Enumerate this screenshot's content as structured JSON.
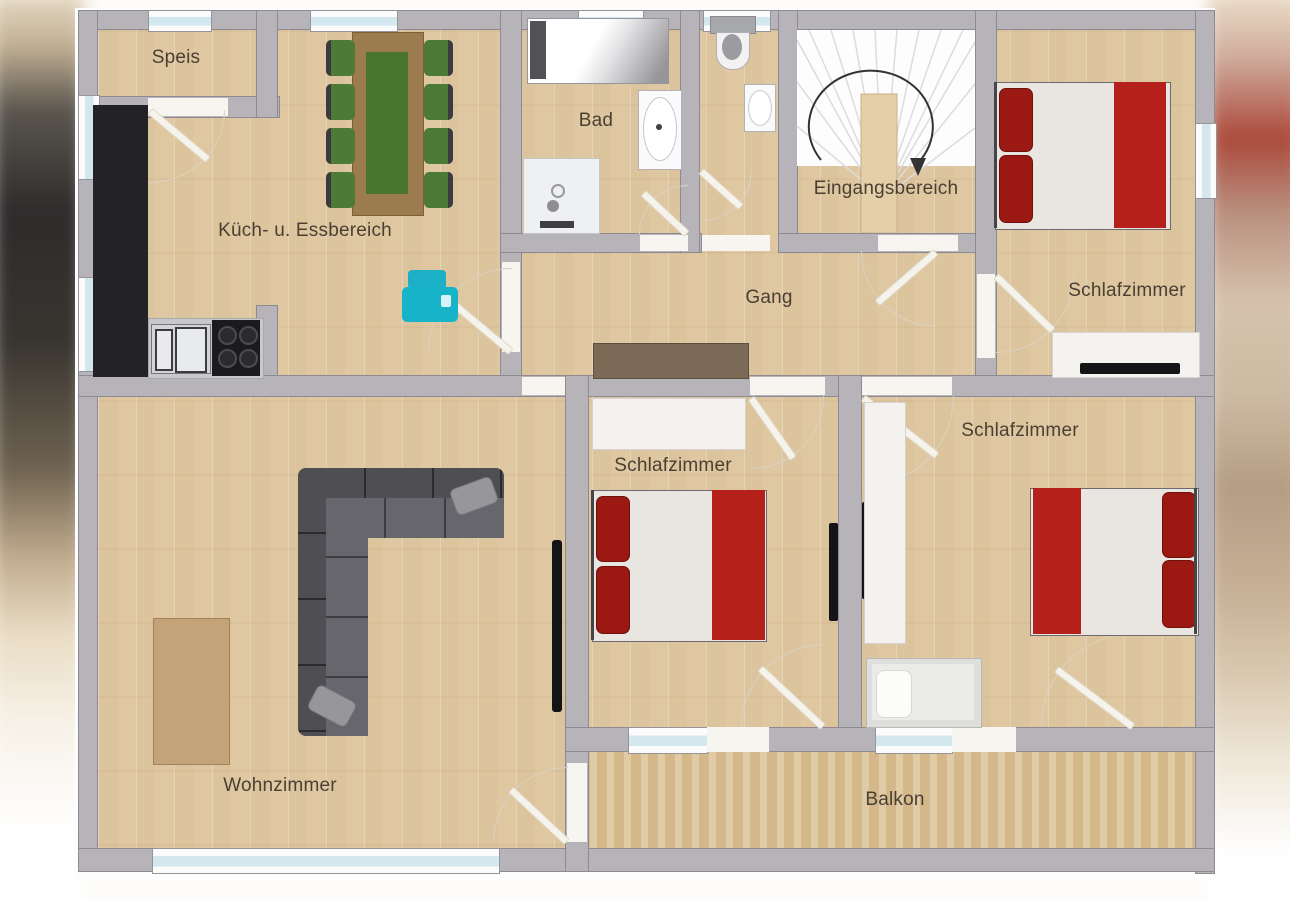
{
  "plan": {
    "type": "floor-plan",
    "language": "de"
  },
  "rooms": [
    {
      "id": "speis",
      "label": "Speis"
    },
    {
      "id": "kueche",
      "label": "Küch- u. Essbereich"
    },
    {
      "id": "bad",
      "label": "Bad"
    },
    {
      "id": "eingangsbereich",
      "label": "Eingangsbereich"
    },
    {
      "id": "schlafzimmer-nordost",
      "label": "Schlafzimmer"
    },
    {
      "id": "gang",
      "label": "Gang"
    },
    {
      "id": "schlafzimmer-mitte",
      "label": "Schlafzimmer"
    },
    {
      "id": "schlafzimmer-ost",
      "label": "Schlafzimmer"
    },
    {
      "id": "wohnzimmer",
      "label": "Wohnzimmer"
    },
    {
      "id": "balkon",
      "label": "Balkon"
    }
  ],
  "palette": {
    "wall": "#b6b4b9",
    "wall_outline": "#8d8b91",
    "floor_wood": "#e2cca6",
    "balcony_wood": "#dac092",
    "window_blue": "#d3e7ef",
    "accent_red": "#b5201a",
    "pillow_red": "#9c1812",
    "sofa_gray": "#4e4e53",
    "table_wood": "#9c7b4e",
    "runner_green": "#49762f",
    "chair_green": "#4d7a36",
    "counter_black": "#232327",
    "appliance_teal": "#17b3c9",
    "label_text": "#4a3f33"
  },
  "furniture": [
    "pantry",
    "kitchen-counter",
    "kitchen-sink",
    "stove",
    "dining-table",
    "dining-chair",
    "printer",
    "bathtub",
    "shower",
    "washbasin",
    "toilet",
    "staircase",
    "sideboard",
    "double-bed",
    "single-bed",
    "wardrobe",
    "dresser",
    "tv",
    "sofa",
    "rug"
  ]
}
